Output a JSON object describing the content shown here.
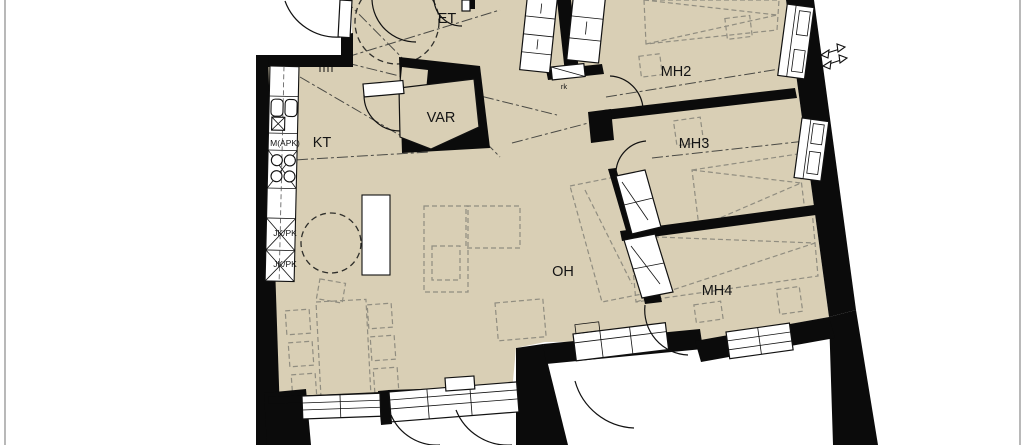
{
  "drawing": {
    "kind": "apartment-floor-plan",
    "rooms": {
      "et": {
        "label": "ET"
      },
      "var": {
        "label": "VAR"
      },
      "kt": {
        "label": "KT"
      },
      "oh": {
        "label": "OH"
      },
      "mh2": {
        "label": "MH2"
      },
      "mh3": {
        "label": "MH3"
      },
      "mh4": {
        "label": "MH4"
      }
    },
    "fixtures": {
      "dishwasher_label": "M(APK)",
      "fridge_label_1": "JK/PK",
      "fridge_label_2": "JK/PK",
      "closet_label": "rk"
    },
    "icons": {
      "direction_arrows": "double-arrow-markers"
    },
    "colors": {
      "floor": "#D9CFB5",
      "wall": "#0B0B0B",
      "furniture_dash": "#908D80",
      "background": "#FFFFFF"
    }
  }
}
